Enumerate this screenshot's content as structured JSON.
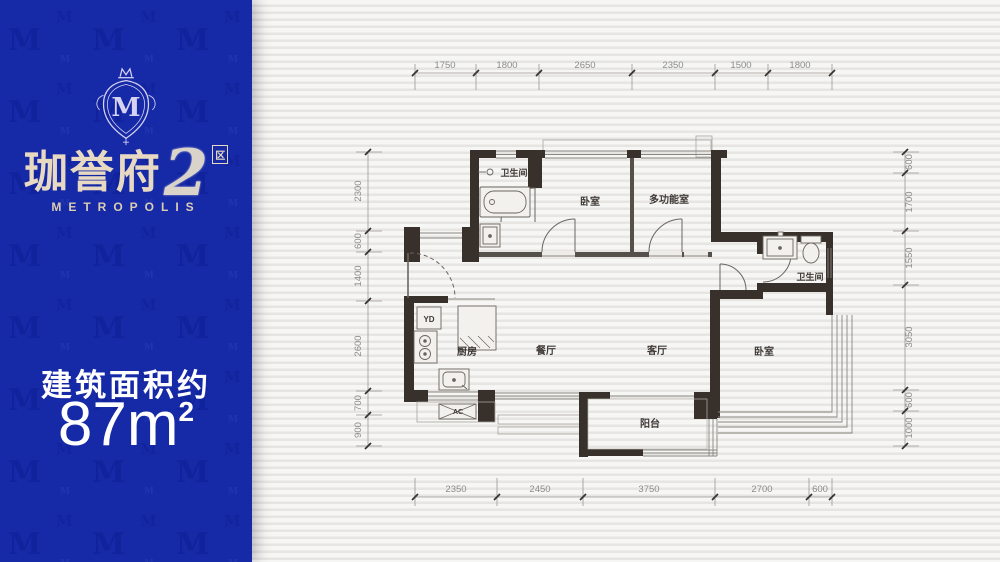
{
  "panel": {
    "pattern_letter": "M",
    "crest_letter": "M",
    "brand_chinese": "珈誉府",
    "brand_number": "2",
    "brand_badge": "区",
    "brand_sub": "METROPOLIS",
    "area_label": "建筑面积约",
    "area_value": "87",
    "area_unit_m": "m",
    "area_unit_exp": "2",
    "colors": {
      "panel_blue": "#1629a6",
      "brand_cream": "#e8d9c2",
      "area_text": "#ffffff"
    }
  },
  "plan": {
    "rooms": [
      "卫生间",
      "卧室",
      "多功能室",
      "卫生间",
      "厨房",
      "餐厅",
      "客厅",
      "卧室",
      "阳台"
    ],
    "fixtures": {
      "flue": "YD",
      "ac": "AC"
    },
    "dims": {
      "top": [
        "1750",
        "1800",
        "2650",
        "2350",
        "1500",
        "1800"
      ],
      "bottom": [
        "2350",
        "2450",
        "3750",
        "2700",
        "600"
      ],
      "left": [
        "2300",
        "600",
        "1400",
        "2600",
        "700",
        "900"
      ],
      "right": [
        "600",
        "1700",
        "1550",
        "3050",
        "600",
        "1000"
      ]
    },
    "colors": {
      "wall": "#38302a",
      "thin_line": "#8a8680",
      "dim_text": "#8c8c8c"
    }
  }
}
